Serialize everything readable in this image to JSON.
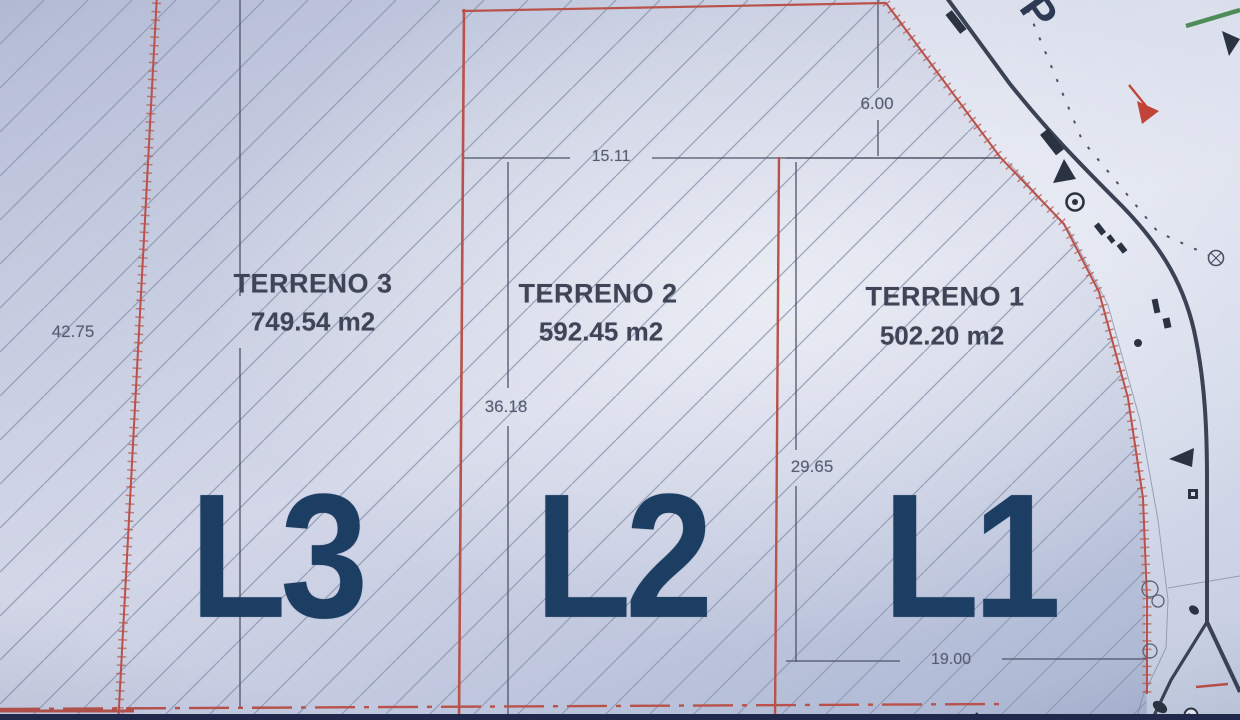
{
  "parcels": [
    {
      "name": "TERRENO 3",
      "area": "749.54 m2",
      "lot": "L3"
    },
    {
      "name": "TERRENO 2",
      "area": "592.45 m2",
      "lot": "L2"
    },
    {
      "name": "TERRENO 1",
      "area": "502.20 m2",
      "lot": "L1"
    }
  ],
  "dimensions": {
    "terreno3_depth": "42.75",
    "terreno2_front": "15.11",
    "terreno2_depth": "36.18",
    "terreno1_side": "6.00",
    "terreno1_depth": "29.65",
    "terreno1_front": "19.00"
  },
  "street": {
    "visible_letter": "P"
  },
  "colors": {
    "boundary_red": "#b8524a",
    "road_line": "#3a4254",
    "lot_label_navy": "#1c3e63",
    "arrow_red": "#c04437",
    "green_mark": "#4f8d58",
    "paper_blue": "#c9cfe3"
  }
}
